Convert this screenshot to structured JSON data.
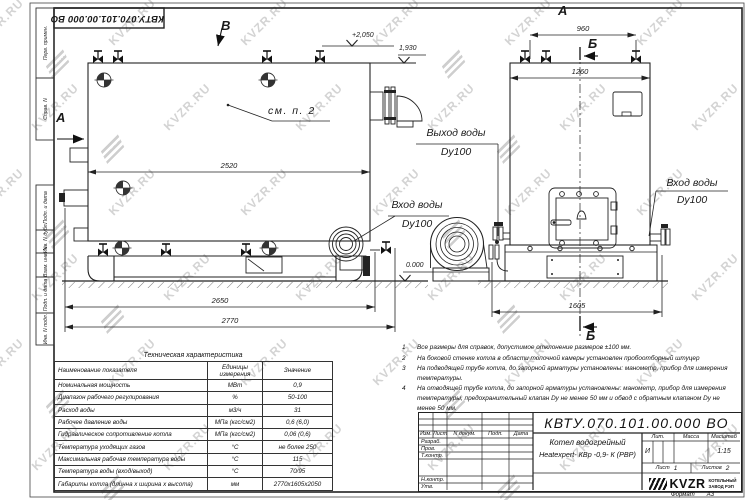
{
  "watermark": {
    "text": "KVZR.RU"
  },
  "stamp_top": {
    "doc_number": "КВТУ.070.101.00.000  ВО"
  },
  "margin_labels": [
    "Перв. примен.",
    "Справ. N",
    "Подп. и дата",
    "Инв. N дубл.",
    "Взам. инв. N",
    "Подп. и дата",
    "Инв. N подл."
  ],
  "labels": {
    "b_view": "В",
    "a_view_left": "А",
    "a_view_top": "А",
    "b_section_top": "Б",
    "b_section_bottom": "Б",
    "lvl_2050": "+2,050",
    "lvl_1930": "1,930",
    "lvl_0": "0.000",
    "see_note": "см. п. 2",
    "outlet_line1": "Выход воды",
    "outlet_line2": "Dy100",
    "inlet1_line1": "Вход воды",
    "inlet1_line2": "Dy100",
    "inlet2_line1": "Вход воды",
    "inlet2_line2": "Dy100",
    "dim_2520": "2520",
    "dim_2650": "2650",
    "dim_2770": "2770",
    "dim_960": "960",
    "dim_1260": "1260",
    "dim_1605": "1605"
  },
  "notes": [
    {
      "num": "1",
      "text": "Все размеры для справок, допустимое отклонение размеров ±100 мм."
    },
    {
      "num": "2",
      "text": "На боковой стенке котла в области топочной камеры установлен пробоотборный штуцер"
    },
    {
      "num": "3",
      "text": "На подводящей трубе котла, до запорной арматуры установлены: манометр, прибор для измерения температуры."
    },
    {
      "num": "4",
      "text": "На отводящей трубе котла, до запорной арматуры установлены: манометр, прибор для измерения температуры, предохранительный клапан Dу не менее 50 мм и обвод с обратным клапаном Dу не менее 50 мм."
    }
  ],
  "tech_table": {
    "title": "Техническая характеристика",
    "headers": [
      "Наименование показателя",
      "Единицы измерения",
      "Значение"
    ],
    "rows": [
      {
        "label": "Номинальная мощность",
        "unit": "МВт",
        "value": "0,9"
      },
      {
        "label": "Диапазон рабочего регулирования",
        "unit": "%",
        "value": "50-100"
      },
      {
        "label": "Расход воды",
        "unit": "м3/ч",
        "value": "31"
      },
      {
        "label": "Рабочее давление воды",
        "unit": "МПа (кгс/см2)",
        "value": "0,6 (6,0)"
      },
      {
        "label": "Гидравлическое сопротивление котла",
        "unit": "МПа (кгс/см2)",
        "value": "0,06 (0,6)"
      },
      {
        "label": "Температура уходящих газов",
        "unit": "°С",
        "value": "не более 250"
      },
      {
        "label": "Максимальная рабочая температура воды",
        "unit": "°С",
        "value": "115"
      },
      {
        "label": "Температура воды (вход/выход)",
        "unit": "°С",
        "value": "70/95"
      },
      {
        "label": "Габариты котла (длинна х ширина х высота)",
        "unit": "мм",
        "value": "2770х1605х2050"
      }
    ]
  },
  "title_block": {
    "doc_number": "КВТУ.070.101.00.000  ВО",
    "product_line1": "Котел водогрейный",
    "product_line2": "Heatexpert- КВр -0,9- К (РВР)",
    "col_izm": "Изм.",
    "col_list": "Лист",
    "col_dok": "N докум.",
    "col_podp": "Подп.",
    "col_data": "Дата",
    "row_razrab": "Разраб.",
    "row_prov": "Пров.",
    "row_tkontr": "Т.контр.",
    "row_nkontr": "Н.контр.",
    "row_utv": "Утв.",
    "lit_label": "Лит.",
    "lit_value": "И",
    "mass_label": "Масса",
    "scale_label": "Масштаб",
    "scale_value": "1:15",
    "sheet_label": "Лист",
    "sheet_value": "1",
    "sheets_label": "Листов",
    "sheets_value": "2",
    "logo_text": "KVZR",
    "logo_sub1": "КОТЕЛЬНЫЙ",
    "logo_sub2": "ЗАВОД РЭП",
    "format_label": "Формат",
    "format_value": "А3"
  }
}
